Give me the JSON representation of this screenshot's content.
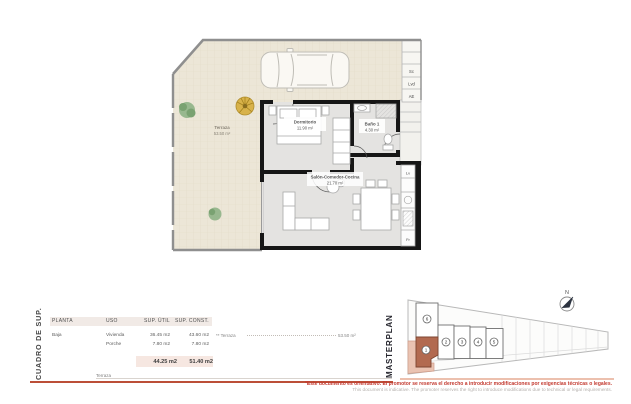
{
  "plan": {
    "rooms": {
      "terraza": {
        "name": "Terraza",
        "area": "53.50 m²"
      },
      "dormitorio": {
        "name": "Dormitorio",
        "area": "11.90 m²"
      },
      "bano": {
        "name": "Baño 1",
        "area": "4.30 m²"
      },
      "salon": {
        "name": "Salón-Comedor-Cocina",
        "area": "21.70 m²"
      }
    },
    "appliance_labels": {
      "sc": "Sc",
      "lvd": "Lvd",
      "ae": "AE",
      "lv": "Lv",
      "fr": "Fr"
    }
  },
  "surface_table": {
    "side_title": "CUADRO DE SUP.",
    "headers": {
      "planta": "PLANTA",
      "uso": "USO",
      "sup_util": "SUP. ÚTIL",
      "sup_const": "SUP. CONST."
    },
    "rows": [
      {
        "planta": "Baja",
        "uso": "Vivienda",
        "sup_util": "36.45 m2",
        "sup_const": "43.60 m2"
      },
      {
        "planta": "",
        "uso": "Porche",
        "sup_util": "7.80 m2",
        "sup_const": "7.80 m2"
      }
    ],
    "totals": {
      "sup_util": "44.25 m2",
      "sup_const": "51.40 m2"
    },
    "terraza_note": {
      "label": "** Terraza",
      "value": "53.50 m²"
    },
    "next_section_label": "Terraza"
  },
  "masterplan": {
    "side_title": "MASTERPLAN",
    "units": [
      {
        "label": "1",
        "highlighted": true
      },
      {
        "label": "2",
        "highlighted": false
      },
      {
        "label": "3",
        "highlighted": false
      },
      {
        "label": "4",
        "highlighted": false
      },
      {
        "label": "5",
        "highlighted": false
      },
      {
        "label": "6",
        "highlighted": false
      }
    ],
    "north_label": "N"
  },
  "footer": {
    "disclaimer_es": "*Este documento es orientativo. El promotor se reserva el derecho a introducir modificaciones por exigencias técnicas o legales.",
    "disclaimer_en": "This document is indicative. The promoter reserves the right to introduce modifications due to technical or legal requirements."
  },
  "colors": {
    "unit_highlight": "#b26a50",
    "terrace_fill": "#ece6d7",
    "divider_red": "#bc4f38",
    "disclaimer_red": "#c3392f"
  }
}
